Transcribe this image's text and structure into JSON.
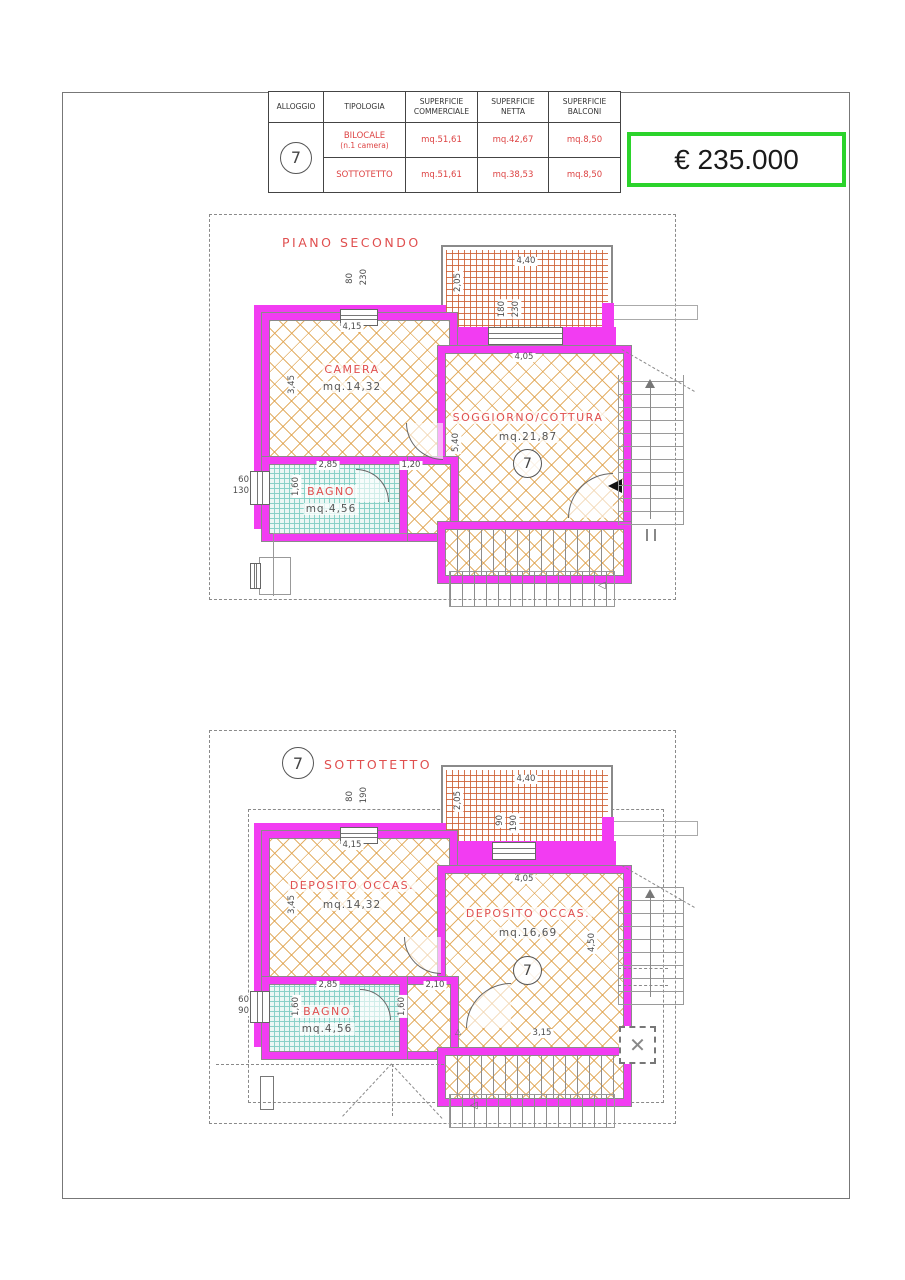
{
  "table": {
    "col_headers": [
      "ALLOGGIO",
      "TIPOLOGIA",
      "SUPERFICIE\nCOMMERCIALE",
      "SUPERFICIE\nNETTA",
      "SUPERFICIE\nBALCONI"
    ],
    "unit_number": "7",
    "rows": [
      {
        "tipologia": "BILOCALE",
        "tipologia_sub": "(n.1  camera)",
        "commerciale": "mq.51,61",
        "netta": "mq.42,67",
        "balconi": "mq.8,50"
      },
      {
        "tipologia": "SOTTOTETTO",
        "tipologia_sub": "",
        "commerciale": "mq.51,61",
        "netta": "mq.38,53",
        "balconi": "mq.8,50"
      }
    ]
  },
  "price": "€ 235.000",
  "plan_second": {
    "title": "PIANO SECONDO",
    "unit_number": "7",
    "rooms": {
      "camera": {
        "name": "CAMERA",
        "area": "mq.14,32"
      },
      "soggiorno": {
        "name": "SOGGIORNO/COTTURA",
        "area": "mq.21,87"
      },
      "bagno": {
        "name": "BAGNO",
        "area": "mq.4,56"
      }
    },
    "dims": {
      "balcony_w": "4,40",
      "balcony_d": "2,05",
      "balcony_win_w": "180",
      "balcony_win_h": "230",
      "top_win_w": "80",
      "top_win_h": "230",
      "camera_w": "4,15",
      "camera_h": "3,45",
      "soggiorno_w": "4,05",
      "soggiorno_h": "5,40",
      "hall_w": "1,20",
      "bagno_w": "2,85",
      "bagno_h": "1,60",
      "side_win_w": "60",
      "side_win_h": "130"
    }
  },
  "plan_sottotetto": {
    "title": "SOTTOTETTO",
    "unit_number": "7",
    "rooms": {
      "deposito1": {
        "name": "DEPOSITO  OCCAS.",
        "area": "mq.14,32"
      },
      "deposito2": {
        "name": "DEPOSITO  OCCAS.",
        "area": "mq.16,69"
      },
      "bagno": {
        "name": "BAGNO",
        "area": "mq.4,56"
      }
    },
    "dims": {
      "balcony_w": "4,40",
      "balcony_d": "2,05",
      "balcony_win_w": "90",
      "balcony_win_h": "190",
      "top_win_w": "80",
      "top_win_h": "190",
      "dep1_w": "4,15",
      "dep1_h": "3,45",
      "dep2_w": "4,05",
      "dep2_h": "4,50",
      "dep2_b": "3,15",
      "hall_w": "2,10",
      "hall_h": "1,60",
      "bagno_w": "2,85",
      "bagno_h": "1,60",
      "side_win_w": "60",
      "side_win_h": "90"
    }
  },
  "colors": {
    "wall_magenta": "#f23cf2",
    "hatch_orange": "#dfa24e",
    "balcony_grid": "#cd5e31",
    "bath_teal": "#85cfc6",
    "label_red": "#e04f4f",
    "price_green": "#2bd32b"
  }
}
